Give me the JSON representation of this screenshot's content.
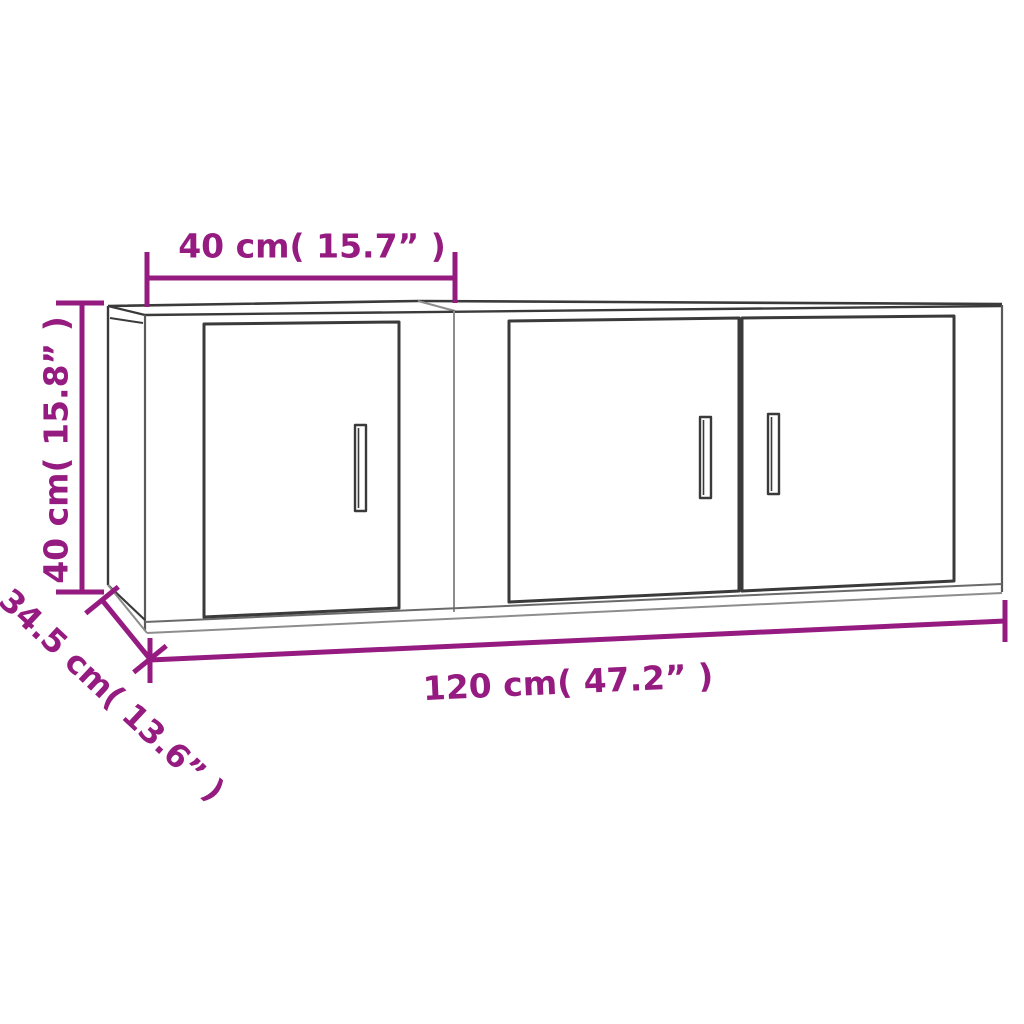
{
  "diagram": {
    "title": "Wall-mounted cabinet set dimension diagram",
    "units": [
      "cm",
      "inch"
    ],
    "colors": {
      "dimension_accent": "#951b81",
      "outline_dark": "#3a3a3a",
      "outline_light": "#8d8d8d",
      "background": "#ffffff"
    },
    "labels": {
      "top_width": "40 cm( 15.7” )",
      "height": "40 cm( 15.8” )",
      "total_width": "120 cm( 47.2” )",
      "depth": "34.5 cm( 13.6” )"
    },
    "cabinets": [
      {
        "name": "left-cabinet",
        "doors": 1,
        "handles": 1
      },
      {
        "name": "right-cabinet",
        "doors": 2,
        "handles": 2
      }
    ]
  }
}
